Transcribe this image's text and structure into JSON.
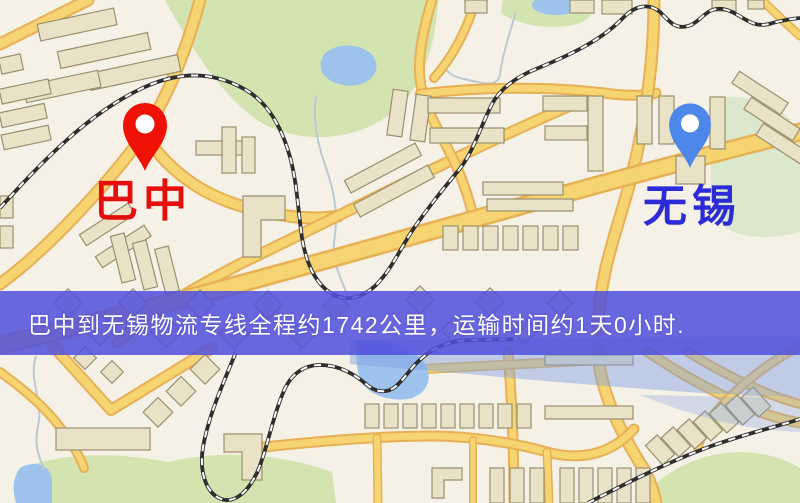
{
  "map": {
    "origin": {
      "name": "巴中",
      "pin_color": "#ee1306",
      "label_color": "#e60d0d"
    },
    "destination": {
      "name": "无锡",
      "pin_color": "#4e87ea",
      "label_color": "#2b2bd8"
    },
    "banner": {
      "text": "巴中到无锡物流专线全程约1742公里，运输时间约1天0小时.",
      "origin": "巴中",
      "destination": "无锡",
      "distance": "约1742公里",
      "duration": "约1天0小时",
      "bg_color": "#5250dc",
      "text_color": "#ffffff"
    },
    "palette": {
      "background": "#f6f1e7",
      "road_fill": "#f7d472",
      "road_casing": "#e7b054",
      "railway": "#2e2e2e",
      "park_green": "#d3e4b0",
      "water_blue": "#9dc3ec",
      "building_beige": "#eae2c6"
    }
  }
}
